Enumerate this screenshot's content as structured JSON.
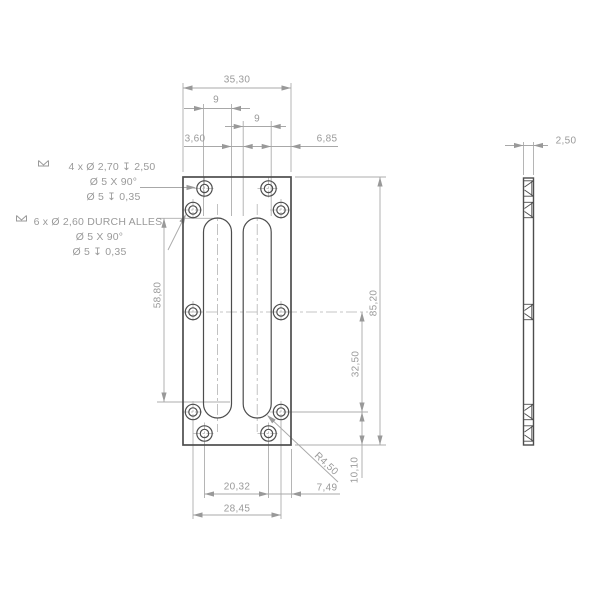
{
  "front_view": {
    "dims": {
      "overall_width": "35,30",
      "left_slot_width": "9",
      "right_slot_width": "9",
      "slot_gap": "3,60",
      "slot_to_right_edge": "6,85",
      "slot_length": "58,80",
      "overall_height": "85,20",
      "hole_row_spacing": "32,50",
      "hole_row_to_bottom_edge": "10,10",
      "csk_hole_cols_spacing": "20,32",
      "thru_hole_cols_spacing": "28,45",
      "csk_hole_col_to_right_edge": "7,49",
      "slot_end_radius": "R4,50"
    },
    "callout_blind_holes": {
      "line1": "4 x Ø 2,70 ↧ 2,50",
      "line2": "Ø 5 X 90°",
      "line3": "Ø 5 ↧ 0,35"
    },
    "callout_through_holes": {
      "line1": "6 x Ø 2,60 DURCH ALLES",
      "line2": "Ø 5 X 90°",
      "line3": "Ø 5 ↧ 0,35"
    }
  },
  "side_view": {
    "thickness": "2,50"
  },
  "colors": {
    "geometry": "#4d4d4d",
    "dimensions": "#a8a8a8",
    "text": "#9a9a9a",
    "background": "#ffffff"
  }
}
